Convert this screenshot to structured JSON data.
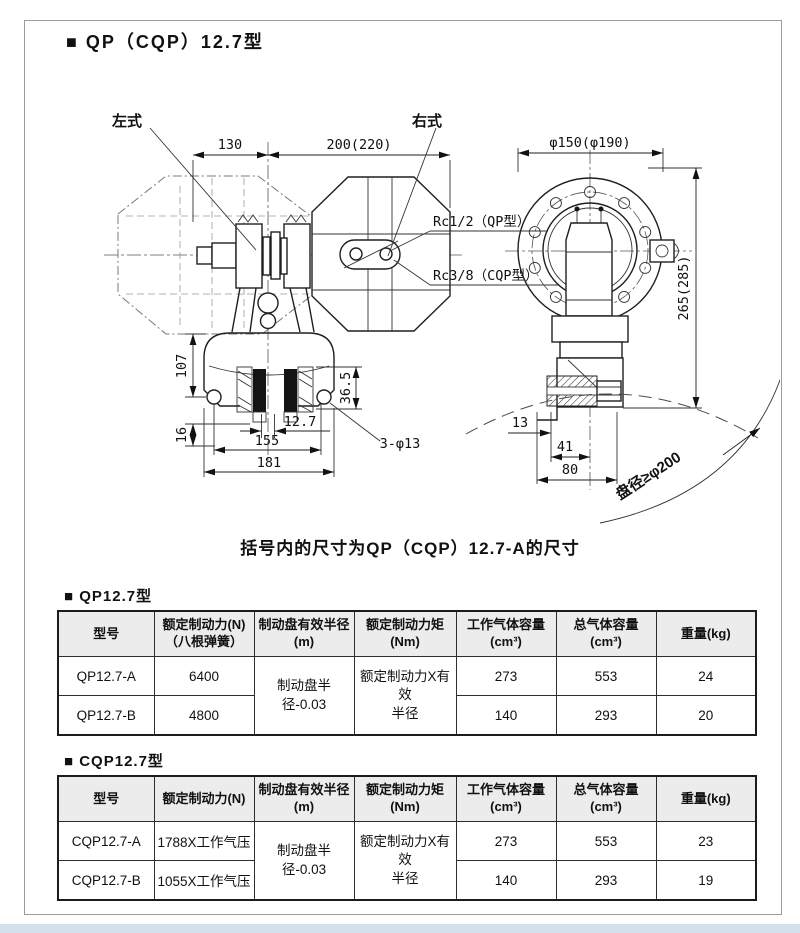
{
  "page": {
    "title": "■ QP（CQP）12.7型",
    "note": "括号内的尺寸为QP（CQP）12.7-A的尺寸"
  },
  "drawing": {
    "labels": {
      "left_style": "左式",
      "right_style": "右式",
      "dim_130": "130",
      "dim_200": "200(220)",
      "rc_qp": "Rc1/2（QP型）",
      "rc_cqp": "Rc3/8（CQP型）",
      "dia_flange": "φ150(φ190)",
      "dim_265": "265(285)",
      "dim_107": "107",
      "dim_36_5": "36.5",
      "dim_16": "16",
      "dim_12_7": "12.7",
      "dim_155": "155",
      "dim_181": "181",
      "holes_note": "3-φ13",
      "dim_13": "13",
      "dim_41": "41",
      "dim_80": "80",
      "disc_note": "盘径≥φ200"
    }
  },
  "tables": [
    {
      "section_title": "■ QP12.7型",
      "headers": [
        {
          "line1": "型号",
          "line2": ""
        },
        {
          "line1": "额定制动力(N)",
          "line2": "（八根弹簧）"
        },
        {
          "line1": "制动盘有效半径",
          "line2": "(m)"
        },
        {
          "line1": "额定制动力矩",
          "line2": "(Nm)"
        },
        {
          "line1": "工作气体容量",
          "line2": "(cm³)"
        },
        {
          "line1": "总气体容量",
          "line2": "(cm³)"
        },
        {
          "line1": "重量(kg)",
          "line2": ""
        }
      ],
      "merged": {
        "radius": "制动盘半径-0.03",
        "torque_l1": "额定制动力X有效",
        "torque_l2": "半径"
      },
      "rows": [
        {
          "model": "QP12.7-A",
          "force": "6400",
          "work_vol": "273",
          "total_vol": "553",
          "weight": "24"
        },
        {
          "model": "QP12.7-B",
          "force": "4800",
          "work_vol": "140",
          "total_vol": "293",
          "weight": "20"
        }
      ]
    },
    {
      "section_title": "■ CQP12.7型",
      "headers": [
        {
          "line1": "型号",
          "line2": ""
        },
        {
          "line1": "额定制动力(N)",
          "line2": ""
        },
        {
          "line1": "制动盘有效半径",
          "line2": "(m)"
        },
        {
          "line1": "额定制动力矩",
          "line2": "(Nm)"
        },
        {
          "line1": "工作气体容量",
          "line2": "(cm³)"
        },
        {
          "line1": "总气体容量",
          "line2": "(cm³)"
        },
        {
          "line1": "重量(kg)",
          "line2": ""
        }
      ],
      "merged": {
        "radius": "制动盘半径-0.03",
        "torque_l1": "额定制动力X有效",
        "torque_l2": "半径"
      },
      "rows": [
        {
          "model": "CQP12.7-A",
          "force": "1788X工作气压",
          "work_vol": "273",
          "total_vol": "553",
          "weight": "23"
        },
        {
          "model": "CQP12.7-B",
          "force": "1055X工作气压",
          "work_vol": "140",
          "total_vol": "293",
          "weight": "19"
        }
      ]
    }
  ]
}
